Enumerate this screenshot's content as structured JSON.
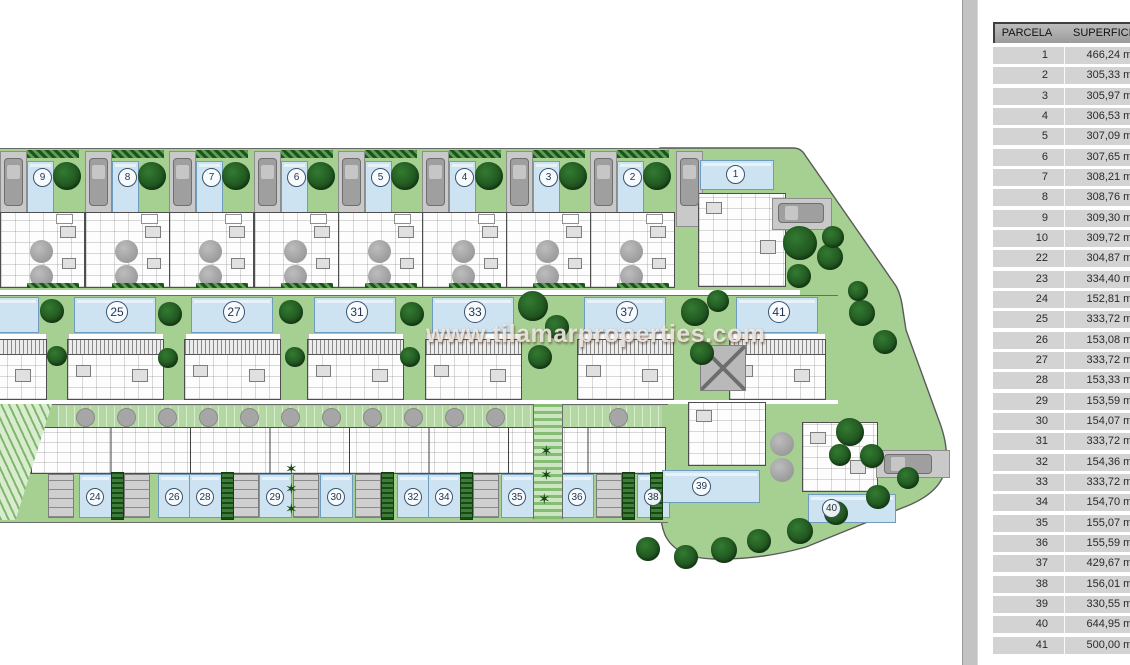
{
  "watermark": {
    "text": "www.tilamarproperties.com"
  },
  "plan": {
    "top_row_plots": [
      "9",
      "8",
      "7",
      "6",
      "5",
      "4",
      "3",
      "2"
    ],
    "corner_plot": "1",
    "middle_row_plots": [
      "25",
      "27",
      "31",
      "33",
      "37",
      "41"
    ],
    "bottom_row_plots": [
      "24",
      "26",
      "28",
      "29",
      "30",
      "32",
      "34",
      "35",
      "36",
      "38"
    ],
    "detached_plot_39": "39",
    "detached_plot_40": "40"
  },
  "table": {
    "headers": [
      "PARCELA",
      "SUPERFICIE"
    ],
    "area_unit": "m²",
    "rows": [
      [
        "1",
        "466,24"
      ],
      [
        "2",
        "305,33"
      ],
      [
        "3",
        "305,97"
      ],
      [
        "4",
        "306,53"
      ],
      [
        "5",
        "307,09"
      ],
      [
        "6",
        "307,65"
      ],
      [
        "7",
        "308,21"
      ],
      [
        "8",
        "308,76"
      ],
      [
        "9",
        "309,30"
      ],
      [
        "10",
        "309,72"
      ],
      [
        "22",
        "304,87"
      ],
      [
        "23",
        "334,40"
      ],
      [
        "24",
        "152,81"
      ],
      [
        "25",
        "333,72"
      ],
      [
        "26",
        "153,08"
      ],
      [
        "27",
        "333,72"
      ],
      [
        "28",
        "153,33"
      ],
      [
        "29",
        "153,59"
      ],
      [
        "30",
        "154,07"
      ],
      [
        "31",
        "333,72"
      ],
      [
        "32",
        "154,36"
      ],
      [
        "33",
        "333,72"
      ],
      [
        "34",
        "154,70"
      ],
      [
        "35",
        "155,07"
      ],
      [
        "36",
        "155,59"
      ],
      [
        "37",
        "429,67"
      ],
      [
        "38",
        "156,01"
      ],
      [
        "39",
        "330,55"
      ],
      [
        "40",
        "644,95"
      ],
      [
        "41",
        "500,00"
      ]
    ]
  },
  "colors": {
    "garden_green": "#a6d092",
    "tree_green": "#1f5a1f",
    "pool_blue": "#cde3f2",
    "pool_border": "#6f9cbd",
    "paving_gray": "#c7c7c7",
    "wall_dark": "#4a4a4a",
    "table_row_gray": "#d3d3d3",
    "table_header_gray": "#a8a8a8"
  }
}
